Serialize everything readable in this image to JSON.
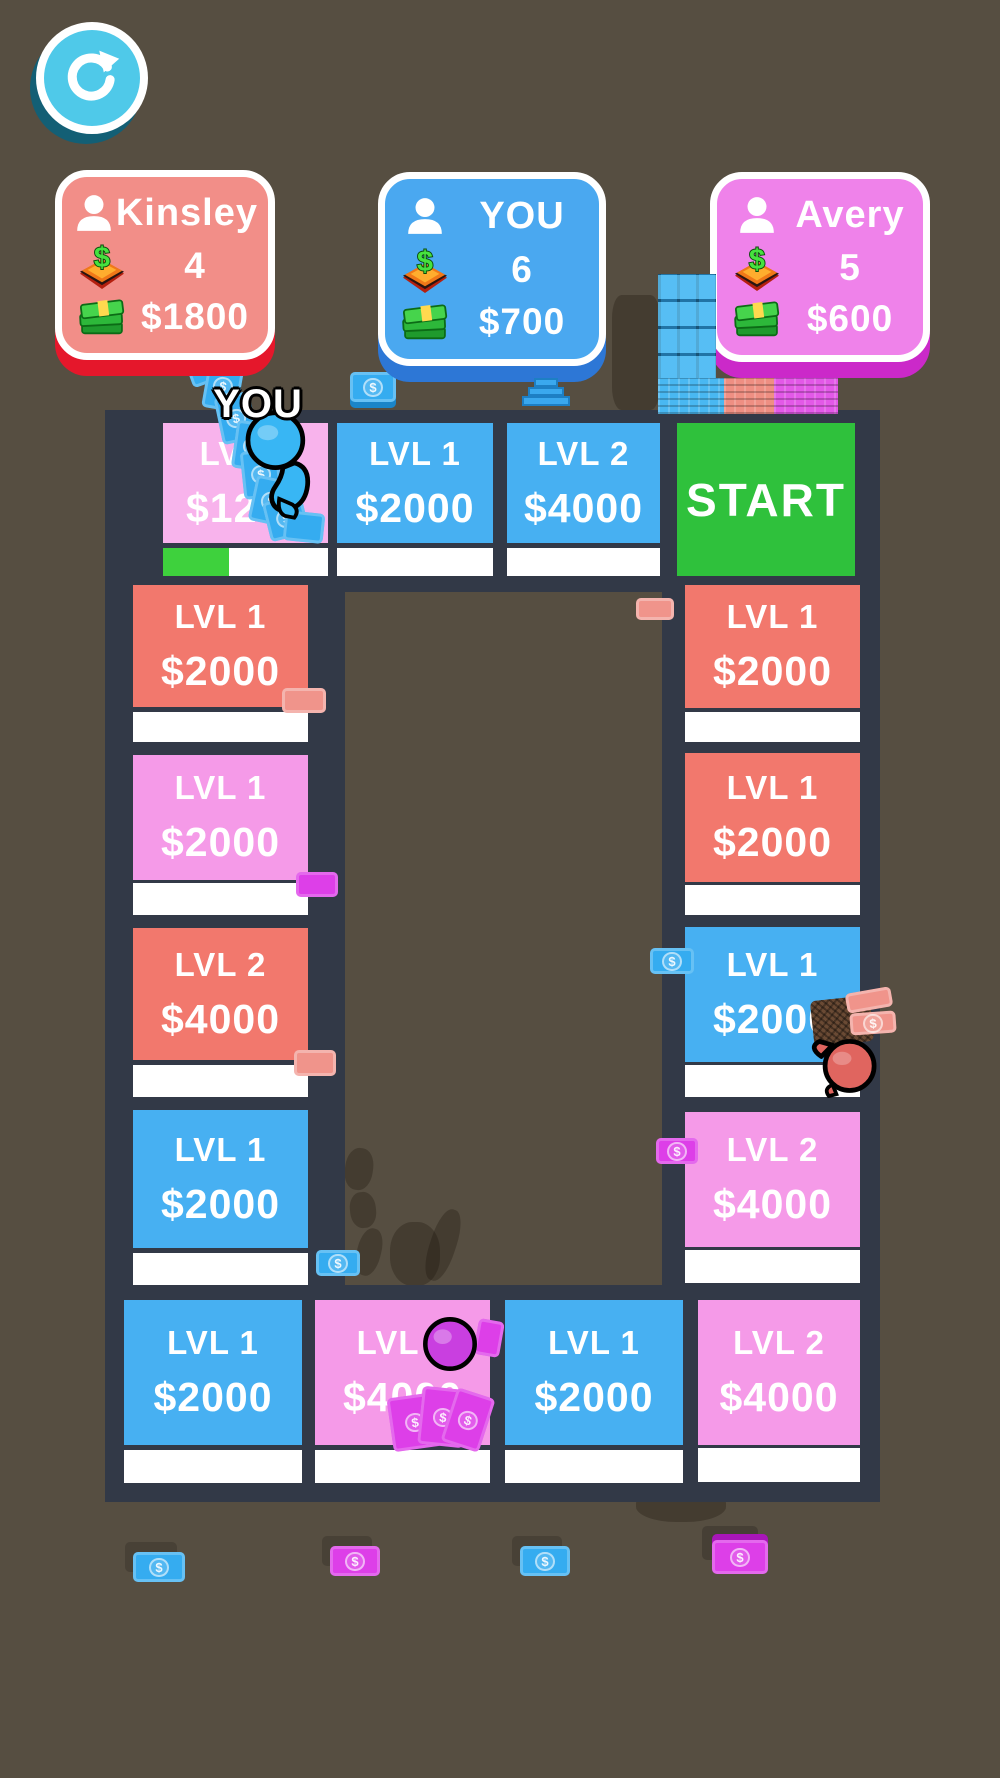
{
  "hud": {
    "restart_button": {
      "icon": "restart-refresh-arrow",
      "color": "#4fc9e9"
    }
  },
  "players": [
    {
      "name": "Kinsley",
      "properties": "4",
      "cash": "$1800",
      "card_color": "#f28e88",
      "accent_color": "#e5172b"
    },
    {
      "name": "YOU",
      "properties": "6",
      "cash": "$700",
      "card_color": "#4aa8f0",
      "accent_color": "#2d77d6"
    },
    {
      "name": "Avery",
      "properties": "5",
      "cash": "$600",
      "card_color": "#ef82ea",
      "accent_color": "#cb29c9"
    }
  ],
  "board": {
    "start_label": "START",
    "tiles": [
      {
        "id": "top-1",
        "level": "LVL 1",
        "price": "$1200",
        "tile_color": "#f8b3ec",
        "progress_percent": 40
      },
      {
        "id": "top-2",
        "level": "LVL 1",
        "price": "$2000",
        "tile_color": "#47b0f2",
        "progress_percent": 0
      },
      {
        "id": "top-3",
        "level": "LVL 2",
        "price": "$4000",
        "tile_color": "#47b0f2",
        "progress_percent": 0
      },
      {
        "id": "left-1",
        "level": "LVL 1",
        "price": "$2000",
        "tile_color": "#f2786d",
        "progress_percent": 0
      },
      {
        "id": "left-2",
        "level": "LVL 1",
        "price": "$2000",
        "tile_color": "#f59ae8",
        "progress_percent": 0
      },
      {
        "id": "left-3",
        "level": "LVL 2",
        "price": "$4000",
        "tile_color": "#f2786d",
        "progress_percent": 0
      },
      {
        "id": "left-4",
        "level": "LVL 1",
        "price": "$2000",
        "tile_color": "#47b0f2",
        "progress_percent": 0
      },
      {
        "id": "bottom-1",
        "level": "LVL 1",
        "price": "$2000",
        "tile_color": "#47b0f2",
        "progress_percent": 0
      },
      {
        "id": "bottom-2",
        "level": "LVL 2",
        "price": "$4000",
        "tile_color": "#f59ae8",
        "progress_percent": 0
      },
      {
        "id": "bottom-3",
        "level": "LVL 1",
        "price": "$2000",
        "tile_color": "#47b0f2",
        "progress_percent": 0
      },
      {
        "id": "bottom-4",
        "level": "LVL 2",
        "price": "$4000",
        "tile_color": "#f59ae8",
        "progress_percent": 0
      },
      {
        "id": "right-1",
        "level": "LVL 1",
        "price": "$2000",
        "tile_color": "#f2786d",
        "progress_percent": 0
      },
      {
        "id": "right-2",
        "level": "LVL 1",
        "price": "$2000",
        "tile_color": "#f2786d",
        "progress_percent": 0
      },
      {
        "id": "right-3",
        "level": "LVL 1",
        "price": "$2000",
        "tile_color": "#47b0f2",
        "progress_percent": 0
      },
      {
        "id": "right-4",
        "level": "LVL 2",
        "price": "$4000",
        "tile_color": "#f59ae8",
        "progress_percent": 0
      }
    ]
  },
  "pawns": [
    {
      "id": "you-pawn",
      "label": "YOU",
      "color": "#38b6f4"
    },
    {
      "id": "kinsley-pawn",
      "label": "",
      "color": "#e0655f"
    },
    {
      "id": "avery-pawn",
      "label": "",
      "color": "#c93fe0"
    }
  ],
  "colors": {
    "background": "#564e41",
    "track": "#323947",
    "tile_blue": "#47b0f2",
    "tile_salmon": "#f2786d",
    "tile_pink": "#f59ae8",
    "tile_start_green": "#2fc13c",
    "progress_green": "#3ed13d",
    "bill_blue": "#35acf0",
    "bill_magenta": "#dd3fe8",
    "bill_salmon": "#f0948b"
  }
}
